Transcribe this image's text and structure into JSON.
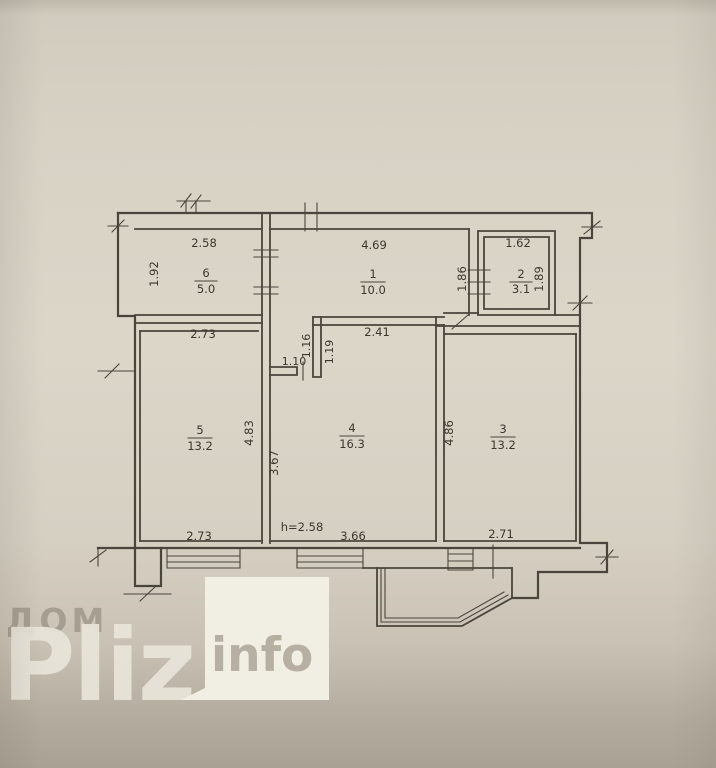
{
  "rooms": {
    "room1": {
      "number": "1",
      "area": "10.0",
      "top_width": "4.69",
      "right_height": "1.86"
    },
    "room2": {
      "number": "2",
      "area": "3.1",
      "top_width": "1.62",
      "right_height": "1.89"
    },
    "room3": {
      "number": "3",
      "area": "13.2",
      "left_height": "4.86",
      "bottom_width": "2.71"
    },
    "room4": {
      "number": "4",
      "area": "16.3",
      "top_width": "2.41",
      "left_height": "3.67",
      "bottom_width": "3.66",
      "ceiling_height": "h=2.58"
    },
    "room5": {
      "number": "5",
      "area": "13.2",
      "top_width": "2.73",
      "right_height": "4.83",
      "bottom_width": "2.73"
    },
    "room6": {
      "number": "6",
      "area": "5.0",
      "top_width": "2.58",
      "left_height": "1.92"
    },
    "hall_nook": {
      "width": "1.10",
      "left_height": "1.16",
      "right_height": "1.19"
    }
  },
  "watermark": {
    "prefix": "ДОМ",
    "brand": "Pliz",
    "suffix": "info"
  },
  "colors": {
    "paper": "#d8d2c5",
    "paper_shadow": "#a9a294",
    "line": "#4a453c",
    "watermark_light": "#e9e5da",
    "watermark_dark": "#8f8779",
    "info_box": "#f1efe4",
    "info_text": "#b6afa2"
  }
}
